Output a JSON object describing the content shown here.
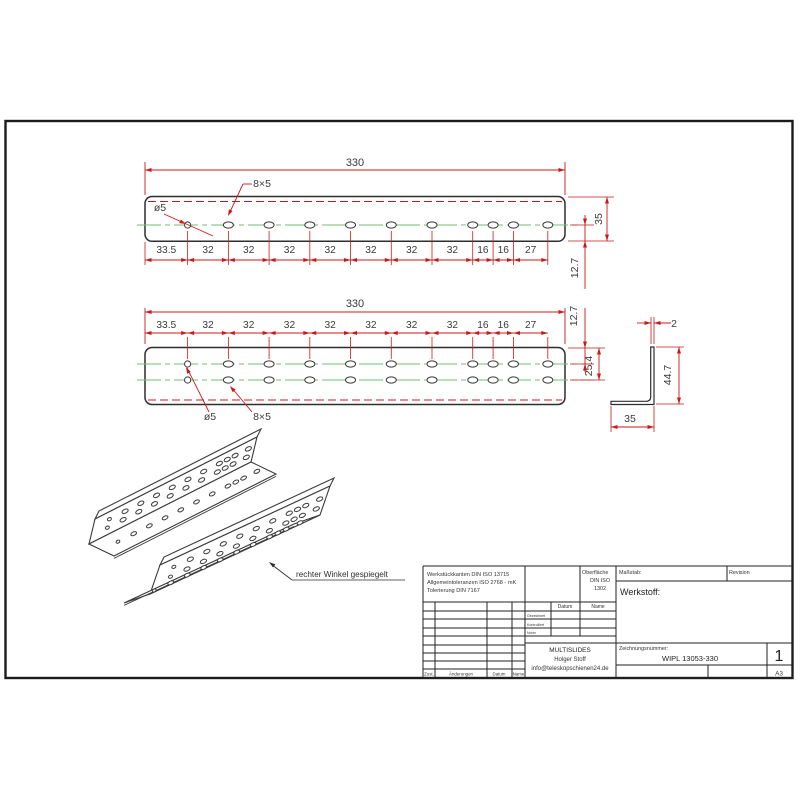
{
  "drawing": {
    "views": {
      "top_view": {
        "length": "330",
        "width": "35",
        "hole_offset": "12.7",
        "chain": [
          "33.5",
          "32",
          "32",
          "32",
          "32",
          "32",
          "32",
          "32",
          "16",
          "16",
          "27"
        ],
        "round_hole": "ø5",
        "slot_hole": "8×5"
      },
      "front_view": {
        "length": "330",
        "row1_offset": "12.7",
        "row2_offset": "25.4",
        "chain": [
          "33.5",
          "32",
          "32",
          "32",
          "32",
          "32",
          "32",
          "32",
          "16",
          "16",
          "27"
        ],
        "round_hole": "ø5",
        "slot_hole": "8×5"
      },
      "section_view": {
        "thickness": "2",
        "height": "44.7",
        "width": "35"
      },
      "iso_view": {
        "caption": "rechter Winkel gespiegelt"
      }
    },
    "title_block": {
      "tolerance_notes": [
        "Werkstückkanten DIN ISO 13715",
        "Allgemeintoleranzen ISO 2768 - mK",
        "Tolerierung DIN 7167"
      ],
      "surface_note": [
        "Oberfläche",
        "DIN ISO",
        "1302"
      ],
      "scale_label": "Maßstab:",
      "revision_label": "Revision",
      "material_label": "Werkstoff:",
      "date_header": "Datum",
      "name_header": "Name",
      "signature_rows": [
        "Gezeichnet",
        "Kontrolliert",
        "Norm"
      ],
      "company_lines": [
        "MULTISLIDES",
        "Holger Stoff",
        "info@teleskopschienen24.de"
      ],
      "drawing_number_label": "Zeichnungsnummer:",
      "drawing_number": "WIPL 13053-330",
      "sheet_number": "1",
      "paper_size": "A3",
      "footer_labels": [
        "Zust.",
        "Änderungen",
        "Datum",
        "Name"
      ]
    },
    "colors": {
      "dimension": "#cc1818",
      "centerline": "#72c172",
      "outline": "#2e2e2e"
    }
  }
}
